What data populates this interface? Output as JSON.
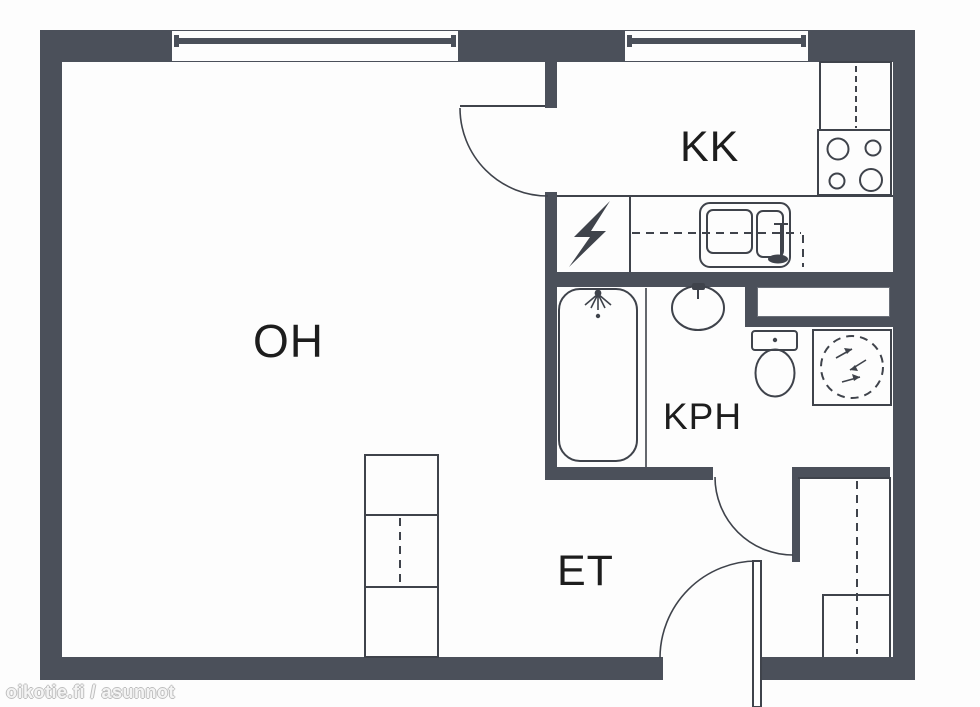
{
  "plan_type": "apartment-floor-plan",
  "rooms": [
    {
      "id": "oh",
      "label": "OH"
    },
    {
      "id": "kk",
      "label": "KK"
    },
    {
      "id": "kph",
      "label": "KPH"
    },
    {
      "id": "et",
      "label": "ET"
    }
  ],
  "watermark": {
    "text": "oikotie.fi / asunnot"
  },
  "fixtures": [
    "window",
    "window",
    "interior-door-arc",
    "kitchen-upper-cabinet",
    "stove-four-burners",
    "kitchen-counter",
    "electrical-panel-bolt",
    "double-basin-sink",
    "bathtub",
    "shower-head",
    "washbasin",
    "toilet",
    "washing-machine",
    "wall-shelf",
    "living-room-wardrobe",
    "hall-closet",
    "entrance-door"
  ],
  "colors": {
    "wall": "#4b505a",
    "line": "#3f434b",
    "text": "#1d1d1d",
    "floor": "#fdfdfd",
    "watermark": "#c9c9c9"
  }
}
